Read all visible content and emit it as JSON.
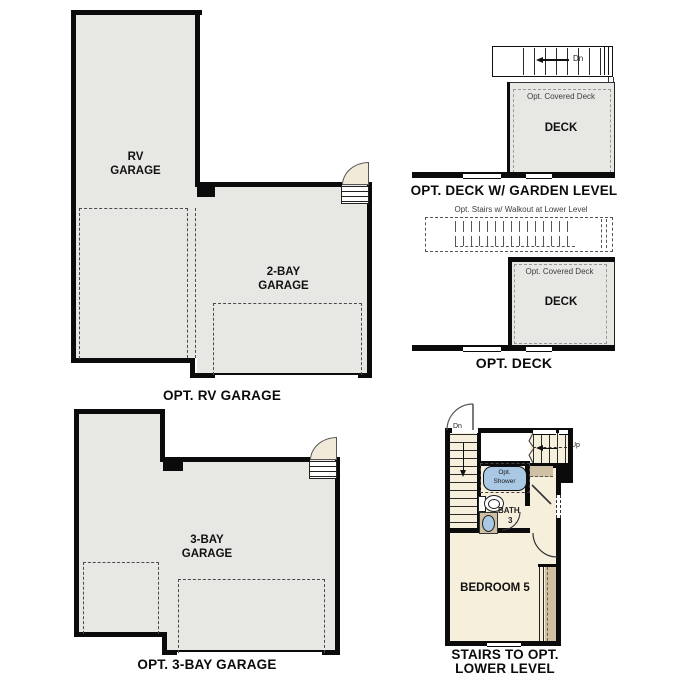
{
  "palette": {
    "wall": "#0b0b0b",
    "room_gray": "#e7e7e4",
    "room_cream": "#f6efdc",
    "cabinet_tan": "#cfc0a4",
    "fixture_blue": "#a9c8e4",
    "door_leaf_fill": "#f2ead9"
  },
  "plans": {
    "opt_rv_garage": {
      "label": "OPT. RV GARAGE",
      "room_rv": [
        "RV",
        "GARAGE"
      ],
      "room_two_bay": [
        "2-BAY",
        "GARAGE"
      ]
    },
    "opt_deck_garden": {
      "label": "OPT. DECK W/ GARDEN LEVEL",
      "room_deck": "DECK",
      "covered_deck_note": "Opt. Covered Deck",
      "stairs_down": "Dn"
    },
    "opt_deck": {
      "label": "OPT. DECK",
      "room_deck": "DECK",
      "covered_deck_note": "Opt. Covered Deck",
      "stairs_note": "Opt. Stairs w/ Walkout at Lower Level"
    },
    "opt_3bay_garage": {
      "label": "OPT. 3-BAY GARAGE",
      "room_three_bay": [
        "3-BAY",
        "GARAGE"
      ]
    },
    "stairs_lower": {
      "label": [
        "STAIRS TO OPT.",
        "LOWER LEVEL"
      ],
      "room_bedroom": "BEDROOM 5",
      "bath": "BATH",
      "bath_number": "3",
      "shower": [
        "Opt.",
        "Shower"
      ],
      "stairs_down": "Dn",
      "stairs_up": "Up"
    }
  }
}
